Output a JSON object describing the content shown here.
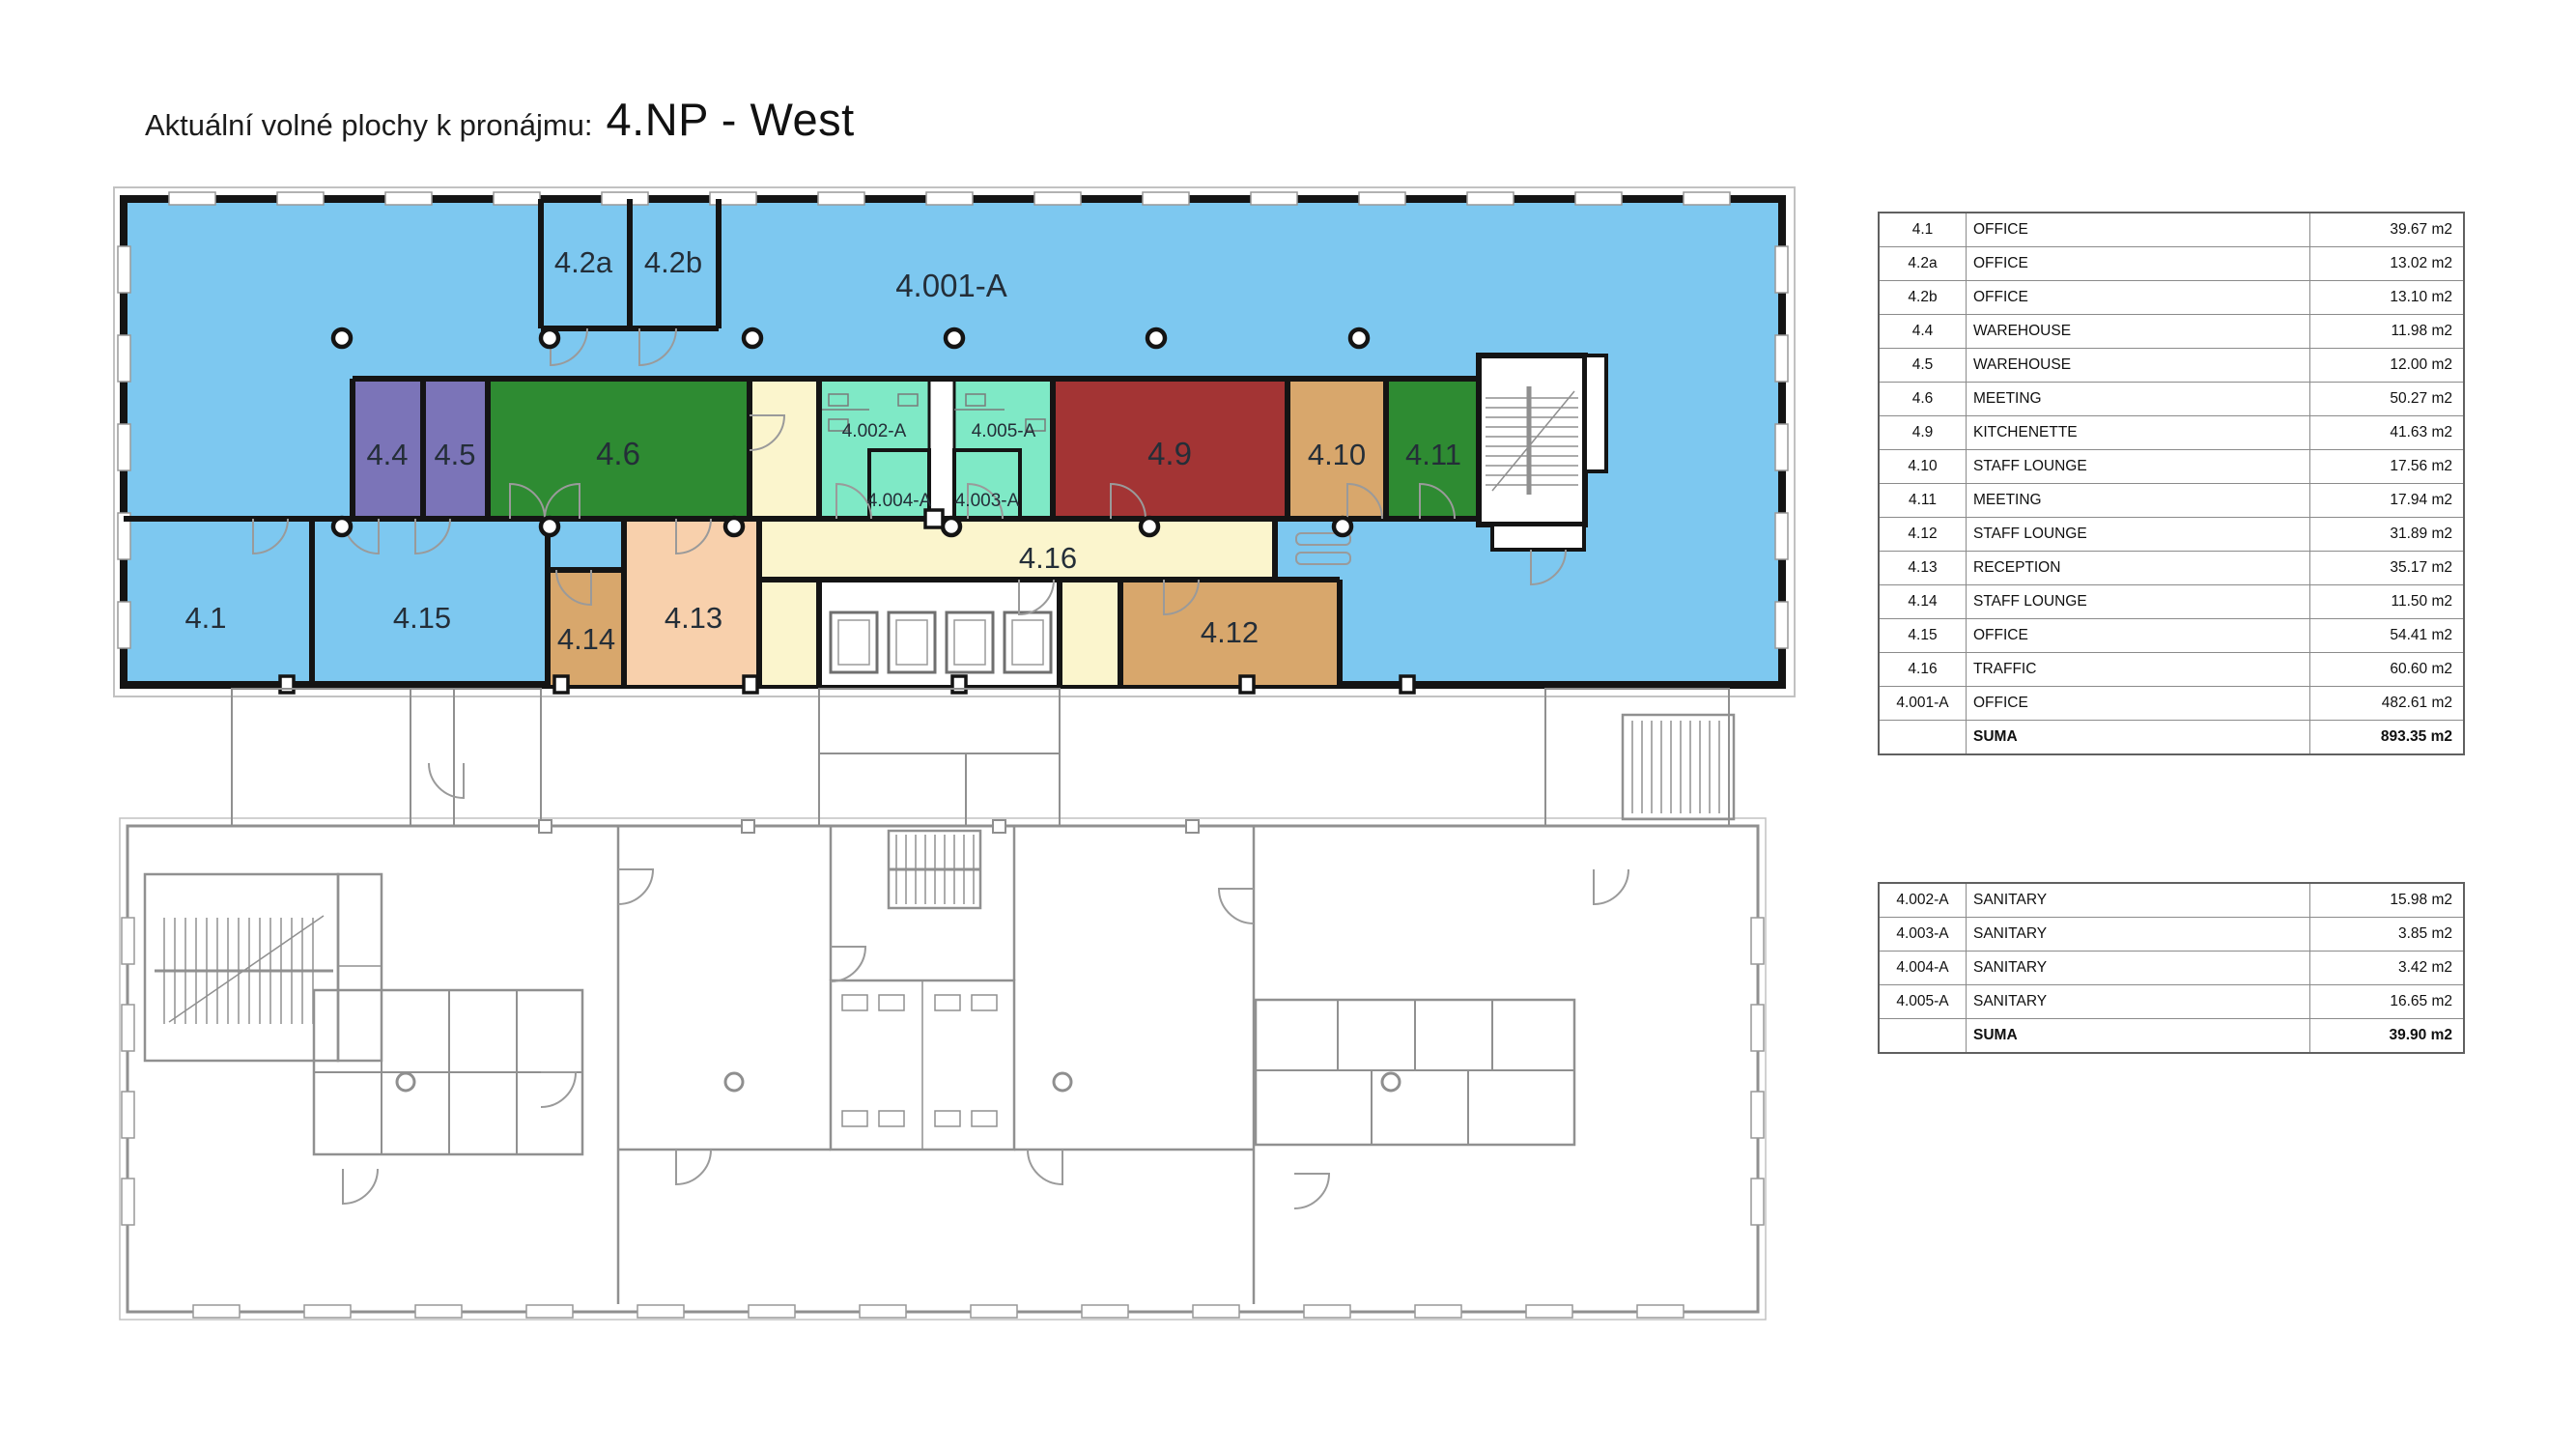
{
  "title": {
    "prefix": "Aktuální volné plochy k pronájmu:",
    "floor": "4.NP - West"
  },
  "plan": {
    "rooms": {
      "r4001a": "4.001-A",
      "r42a": "4.2a",
      "r42b": "4.2b",
      "r44": "4.4",
      "r45": "4.5",
      "r46": "4.6",
      "r49": "4.9",
      "r410": "4.10",
      "r411": "4.11",
      "r412": "4.12",
      "r413": "4.13",
      "r414": "4.14",
      "r415": "4.15",
      "r416": "4.16",
      "r41": "4.1",
      "s4002": "4.002-A",
      "s4003": "4.003-A",
      "s4004": "4.004-A",
      "s4005": "4.005-A"
    }
  },
  "colors": {
    "office_blue": "#7dc8f0",
    "warehouse_purple": "#7b74b8",
    "meeting_green": "#2e8b32",
    "kitchenette_red": "#a33434",
    "staff_lounge_tan": "#d8a76c",
    "reception_peach": "#f8d0ac",
    "traffic_yellow": "#fbf5cd",
    "sanitary_mint": "#7fe9c6",
    "wall_black": "#141414",
    "linework_gray": "#8f8f8f"
  },
  "tables": {
    "main": {
      "rows": [
        {
          "id": "4.1",
          "name": "OFFICE",
          "area": "39.67 m2"
        },
        {
          "id": "4.2a",
          "name": "OFFICE",
          "area": "13.02 m2"
        },
        {
          "id": "4.2b",
          "name": "OFFICE",
          "area": "13.10 m2"
        },
        {
          "id": "4.4",
          "name": "WAREHOUSE",
          "area": "11.98 m2"
        },
        {
          "id": "4.5",
          "name": "WAREHOUSE",
          "area": "12.00 m2"
        },
        {
          "id": "4.6",
          "name": "MEETING",
          "area": "50.27 m2"
        },
        {
          "id": "4.9",
          "name": "KITCHENETTE",
          "area": "41.63 m2"
        },
        {
          "id": "4.10",
          "name": "STAFF LOUNGE",
          "area": "17.56 m2"
        },
        {
          "id": "4.11",
          "name": "MEETING",
          "area": "17.94 m2"
        },
        {
          "id": "4.12",
          "name": "STAFF LOUNGE",
          "area": "31.89 m2"
        },
        {
          "id": "4.13",
          "name": "RECEPTION",
          "area": "35.17 m2"
        },
        {
          "id": "4.14",
          "name": "STAFF LOUNGE",
          "area": "11.50 m2"
        },
        {
          "id": "4.15",
          "name": "OFFICE",
          "area": "54.41 m2"
        },
        {
          "id": "4.16",
          "name": "TRAFFIC",
          "area": "60.60 m2"
        },
        {
          "id": "4.001-A",
          "name": "OFFICE",
          "area": "482.61 m2"
        },
        {
          "id": "",
          "name": "SUMA",
          "area": "893.35 m2",
          "bold": true
        }
      ]
    },
    "sanitary": {
      "rows": [
        {
          "id": "4.002-A",
          "name": "SANITARY",
          "area": "15.98 m2"
        },
        {
          "id": "4.003-A",
          "name": "SANITARY",
          "area": "3.85 m2"
        },
        {
          "id": "4.004-A",
          "name": "SANITARY",
          "area": "3.42 m2"
        },
        {
          "id": "4.005-A",
          "name": "SANITARY",
          "area": "16.65 m2"
        },
        {
          "id": "",
          "name": "SUMA",
          "area": "39.90 m2",
          "bold": true
        }
      ]
    }
  }
}
